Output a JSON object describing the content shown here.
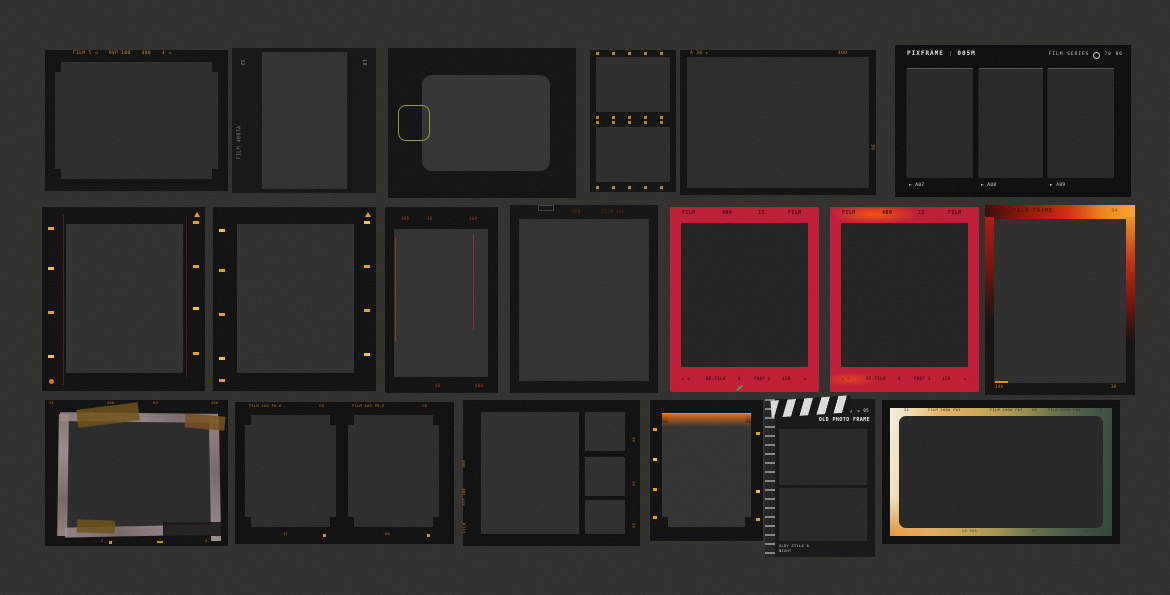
{
  "page": {
    "description": "Collection of 19 dark film frame and photo frame templates on a grainy dark background"
  },
  "colors": {
    "background": "#2c2b28",
    "frame_black": "#0c0c0c",
    "window_gray": "#2a2a2a",
    "orange_accent": "#d9880f",
    "red_frame": "#c11730",
    "red_text": "#a62a12",
    "slide_outline_yellow": "#9a9a30",
    "gradient_gold": "#eab469",
    "gradient_green": "#3c5040",
    "tape_pink": "#a89294",
    "tape_amber": "#6a4e12"
  },
  "frames": {
    "f1": {
      "labels": [
        "FILM 5 ◁",
        "RVP 100",
        "400",
        "4 ◁"
      ]
    },
    "f2": {
      "num_left": "32",
      "num_right": "18",
      "film_label": "FILM 400TA"
    },
    "f5": {
      "top_left": "A 36 ▸",
      "top_right": "400",
      "side": "36"
    },
    "f6": {
      "brand": "PIXFRAME",
      "sep": "|",
      "code": "005M",
      "series": "FILM SERIES",
      "series_num": "70 06",
      "captions": [
        "► A07",
        "► A08",
        "► A09"
      ]
    },
    "f9": {
      "top": [
        "400",
        "40",
        "400"
      ],
      "bottom": [
        "40",
        "400"
      ]
    },
    "f10": {
      "top": [
        "400",
        "FILM 400"
      ]
    },
    "f11": {
      "top": [
        "FILM",
        "400",
        "15",
        "FILM"
      ],
      "bottom": [
        "► ⊙",
        "RE:FILM",
        "X",
        "PRO? 2",
        "120",
        "►"
      ]
    },
    "f12": {
      "top": [
        "FILM",
        "400",
        "15",
        "FILM"
      ],
      "bottom": [
        "► ⊙",
        "RE:FILM",
        "X",
        "PRO? 2",
        "120",
        "►"
      ]
    },
    "f13": {
      "title": "FILM FRAME",
      "num": "34",
      "bottom_left": "14A",
      "bottom_right": "34"
    },
    "f14": {
      "top": [
        "15",
        "400",
        "99",
        "400"
      ],
      "bottom": [
        "2",
        "4"
      ]
    },
    "f15": {
      "header": "FILM 400 PH-6",
      "badge": "C8",
      "counter1": "17",
      "counter2": "08"
    },
    "f16": {
      "left_marks": [
        "400",
        "RVP 100",
        "FILM"
      ],
      "right_marks": [
        "99",
        "99",
        "99"
      ]
    },
    "f18": {
      "take": "► 05",
      "title": "OLD PHOTO FRAME",
      "note1": "OLDY STYLE 8",
      "note2": "NIGHT"
    },
    "f19": {
      "top": [
        "24",
        "FILM 2000 FW3",
        "FILM 2000 FW3",
        "99",
        "FILM 2000 FW3",
        "8"
      ],
      "bottom": [
        "AA 99A",
        "99",
        "AA 99A"
      ]
    }
  }
}
